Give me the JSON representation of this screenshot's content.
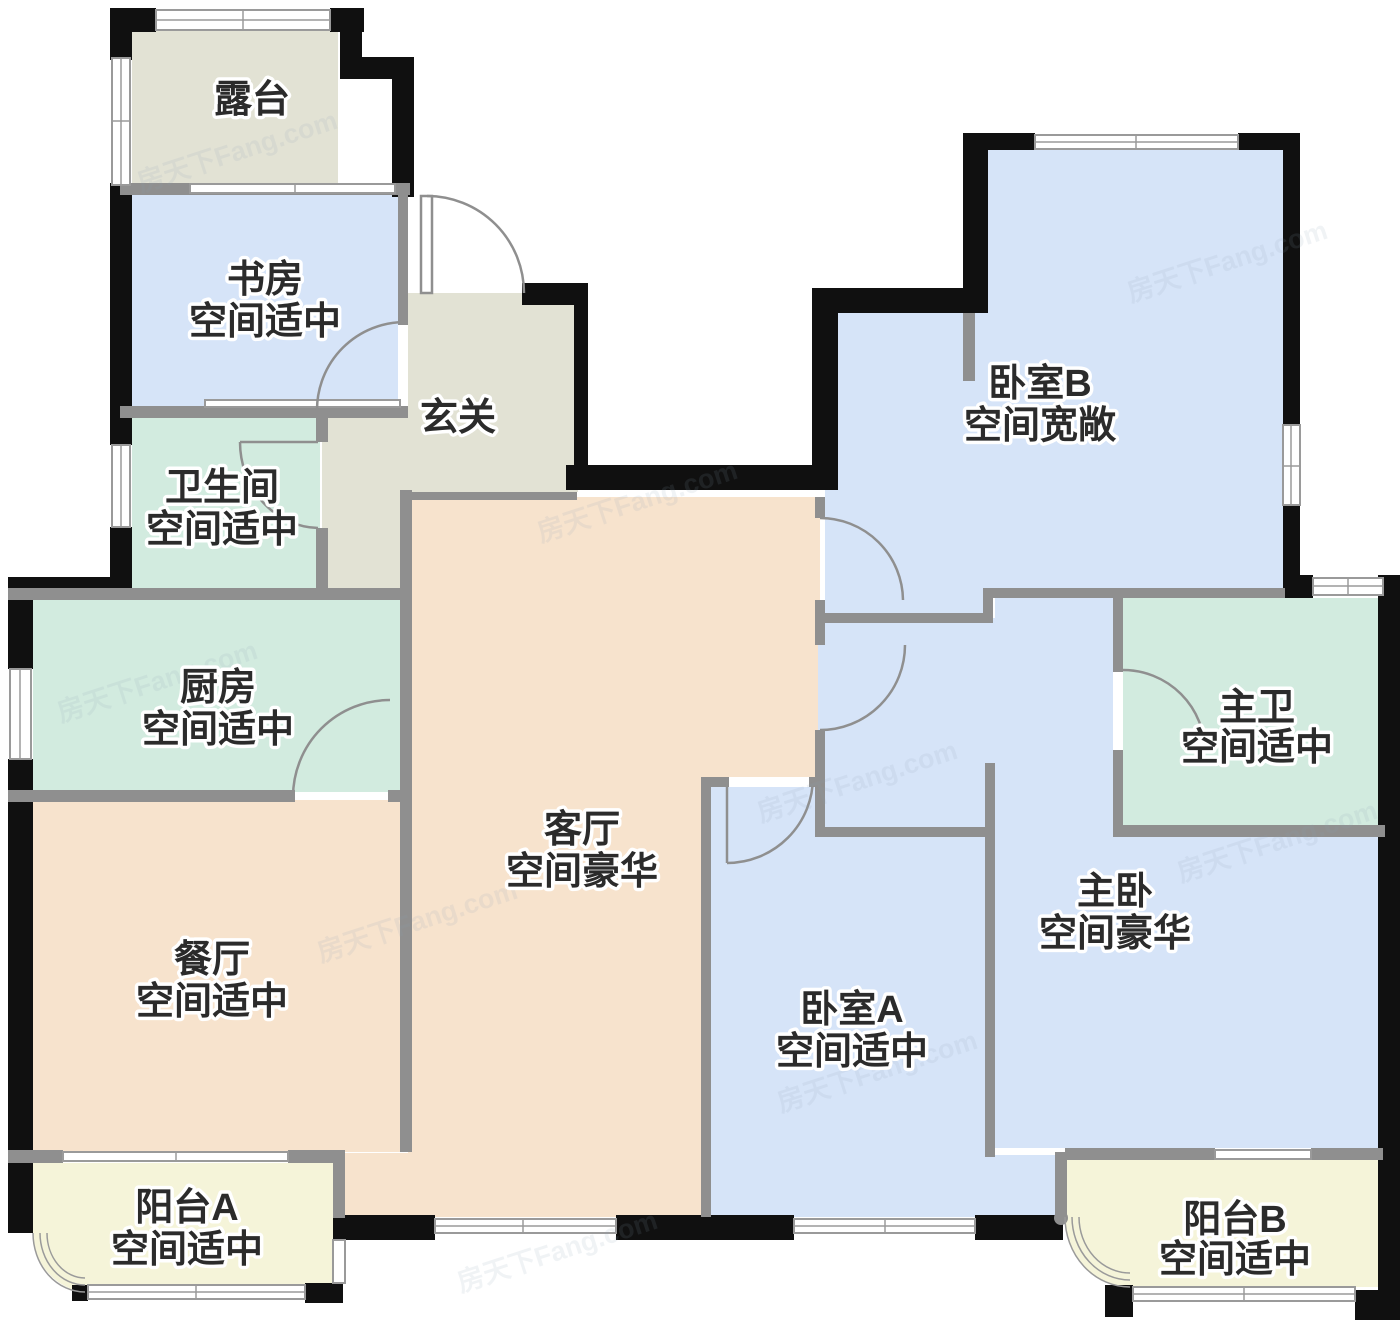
{
  "plan": {
    "watermark": "房天下Fang.com",
    "rooms": {
      "terrace": {
        "name": "露台",
        "note": ""
      },
      "study": {
        "name": "书房",
        "note": "空间适中"
      },
      "hallway": {
        "name": "玄关",
        "note": ""
      },
      "bathroom": {
        "name": "卫生间",
        "note": "空间适中"
      },
      "kitchen": {
        "name": "厨房",
        "note": "空间适中"
      },
      "dining": {
        "name": "餐厅",
        "note": "空间适中"
      },
      "living": {
        "name": "客厅",
        "note": "空间豪华"
      },
      "bedroom_b": {
        "name": "卧室B",
        "note": "空间宽敞"
      },
      "master_bath": {
        "name": "主卫",
        "note": "空间适中"
      },
      "master_bedroom": {
        "name": "主卧",
        "note": "空间豪华"
      },
      "bedroom_a": {
        "name": "卧室A",
        "note": "空间适中"
      },
      "balcony_a": {
        "name": "阳台A",
        "note": "空间适中"
      },
      "balcony_b": {
        "name": "阳台B",
        "note": "空间适中"
      }
    },
    "colors": {
      "beige": "#e2e2d4",
      "blue": "#d6e4f8",
      "mint": "#d2ebdf",
      "peach": "#f7e3cd",
      "yellow": "#f5f4d9",
      "wall": "#101010",
      "inner_wall": "#8f8f8f",
      "label": "#2b2b2b",
      "watermark_color": "#8ea0b5"
    }
  }
}
